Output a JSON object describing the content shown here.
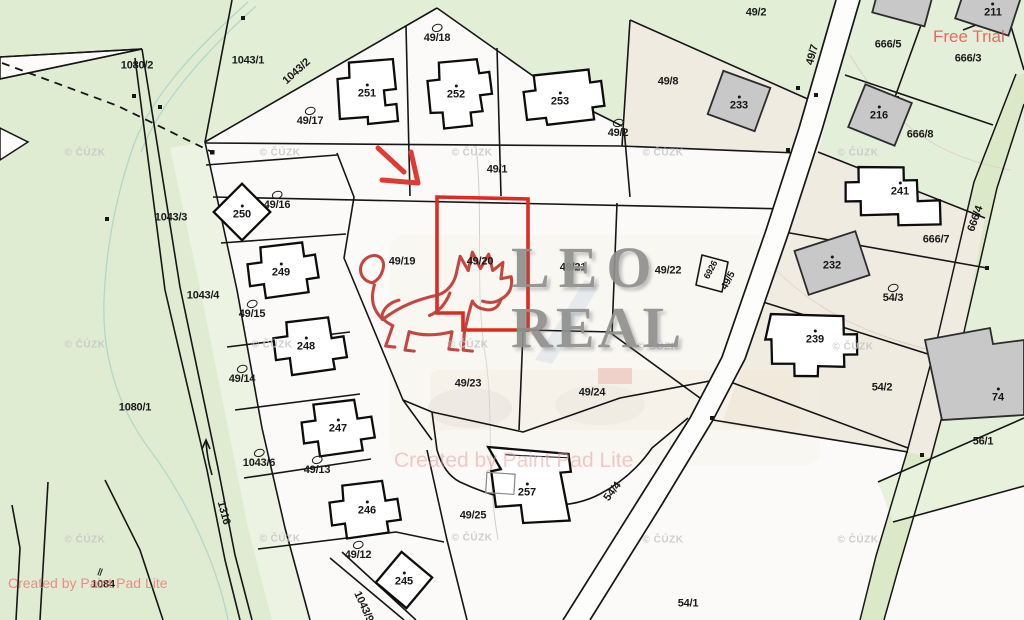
{
  "watermarks": {
    "free_trial": "Free Trial",
    "leo_real_line1": "LEO",
    "leo_real_line2": "REAL",
    "created_by_center": "Created by Paint Pad Lite",
    "created_by_corner": "Created by Paint Pad Lite",
    "cuzk": "© ČÚZK",
    "cuzk_positions": [
      [
        85,
        153
      ],
      [
        280,
        153
      ],
      [
        472,
        153
      ],
      [
        663,
        153
      ],
      [
        858,
        153
      ],
      [
        85,
        345
      ],
      [
        272,
        345
      ],
      [
        468,
        345
      ],
      [
        658,
        347
      ],
      [
        853,
        347
      ],
      [
        85,
        540
      ],
      [
        280,
        539
      ],
      [
        472,
        538
      ],
      [
        663,
        540
      ],
      [
        858,
        540
      ]
    ]
  },
  "highlight": {
    "parcel": "49/20",
    "outline_color": "#dd2b22",
    "arrow_color": "#e03a31"
  },
  "colors": {
    "green_area": "#dfecd2",
    "green_light_strip": "#edf3e2",
    "beige_area": "#f0ebe1",
    "white_area": "#fbfaf8",
    "boundary_line": "#161616",
    "lion_red": "#c43c36",
    "logo_gray": "#8f8f8f",
    "stream_teal": "#a9d3cb"
  },
  "map": {
    "parcel_labels": [
      {
        "t": "1080/2",
        "x": 137,
        "y": 66
      },
      {
        "t": "1043/1",
        "x": 248,
        "y": 61
      },
      {
        "t": "1043/2",
        "x": 297,
        "y": 72,
        "r": -42
      },
      {
        "t": "49/17",
        "x": 310,
        "y": 117,
        "sym": 1
      },
      {
        "t": "49/18",
        "x": 437,
        "y": 34,
        "sym": 1
      },
      {
        "t": "49/2",
        "x": 756,
        "y": 13
      },
      {
        "t": "49/8",
        "x": 668,
        "y": 82
      },
      {
        "t": "49/2",
        "x": 618,
        "y": 129,
        "sym": 1
      },
      {
        "t": "49/7",
        "x": 813,
        "y": 55,
        "r": -75
      },
      {
        "t": "666/5",
        "x": 888,
        "y": 45
      },
      {
        "t": "666/3",
        "x": 968,
        "y": 59
      },
      {
        "t": "666/8",
        "x": 920,
        "y": 135
      },
      {
        "t": "666/7",
        "x": 936,
        "y": 240
      },
      {
        "t": "666/4",
        "x": 976,
        "y": 219,
        "r": -70
      },
      {
        "t": "49/1",
        "x": 497,
        "y": 170
      },
      {
        "t": "49/19",
        "x": 402,
        "y": 262
      },
      {
        "t": "49/20",
        "x": 480,
        "y": 262
      },
      {
        "t": "49/21",
        "x": 573,
        "y": 268
      },
      {
        "t": "49/22",
        "x": 668,
        "y": 271
      },
      {
        "t": "6926",
        "x": 711,
        "y": 270,
        "r": -62,
        "s": 9
      },
      {
        "t": "49/5",
        "x": 729,
        "y": 281,
        "r": -62,
        "s": 10
      },
      {
        "t": "54/3",
        "x": 893,
        "y": 294,
        "sym": 1
      },
      {
        "t": "54/2",
        "x": 882,
        "y": 388
      },
      {
        "t": "56/1",
        "x": 983,
        "y": 442
      },
      {
        "t": "54/4",
        "x": 613,
        "y": 492,
        "r": -52
      },
      {
        "t": "54/1",
        "x": 688,
        "y": 604
      },
      {
        "t": "49/23",
        "x": 468,
        "y": 384
      },
      {
        "t": "49/24",
        "x": 592,
        "y": 393
      },
      {
        "t": "49/25",
        "x": 473,
        "y": 516
      },
      {
        "t": "49/16",
        "x": 277,
        "y": 201,
        "sym": 1
      },
      {
        "t": "1043/3",
        "x": 171,
        "y": 218
      },
      {
        "t": "49/15",
        "x": 252,
        "y": 310,
        "sym": 1
      },
      {
        "t": "1043/4",
        "x": 203,
        "y": 296
      },
      {
        "t": "49/14",
        "x": 242,
        "y": 375,
        "sym": 1
      },
      {
        "t": "1080/1",
        "x": 135,
        "y": 408
      },
      {
        "t": "49/13",
        "x": 317,
        "y": 466,
        "sym": 1
      },
      {
        "t": "1043/6",
        "x": 259,
        "y": 459,
        "sym": 1
      },
      {
        "t": "49/12",
        "x": 358,
        "y": 551,
        "sym": 1
      },
      {
        "t": "1316",
        "x": 223,
        "y": 513,
        "r": 75
      },
      {
        "t": "1084",
        "x": 103,
        "y": 585
      },
      {
        "t": "||",
        "x": 100,
        "y": 572,
        "r": 20,
        "s": 8
      },
      {
        "t": "1043/9",
        "x": 363,
        "y": 607,
        "r": 65
      }
    ],
    "building_labels": [
      {
        "t": "251",
        "x": 367,
        "y": 92
      },
      {
        "t": "252",
        "x": 456,
        "y": 93
      },
      {
        "t": "253",
        "x": 560,
        "y": 100
      },
      {
        "t": "250",
        "x": 242,
        "y": 213
      },
      {
        "t": "249",
        "x": 281,
        "y": 271
      },
      {
        "t": "248",
        "x": 306,
        "y": 345
      },
      {
        "t": "247",
        "x": 338,
        "y": 427
      },
      {
        "t": "246",
        "x": 367,
        "y": 509
      },
      {
        "t": "245",
        "x": 404,
        "y": 580
      },
      {
        "t": "257",
        "x": 527,
        "y": 491
      },
      {
        "t": "233",
        "x": 739,
        "y": 104
      },
      {
        "t": "216",
        "x": 879,
        "y": 114
      },
      {
        "t": "211",
        "x": 993,
        "y": 11
      },
      {
        "t": "241",
        "x": 900,
        "y": 190
      },
      {
        "t": "232",
        "x": 832,
        "y": 264
      },
      {
        "t": "239",
        "x": 815,
        "y": 338
      },
      {
        "t": "74",
        "x": 998,
        "y": 396
      }
    ]
  }
}
